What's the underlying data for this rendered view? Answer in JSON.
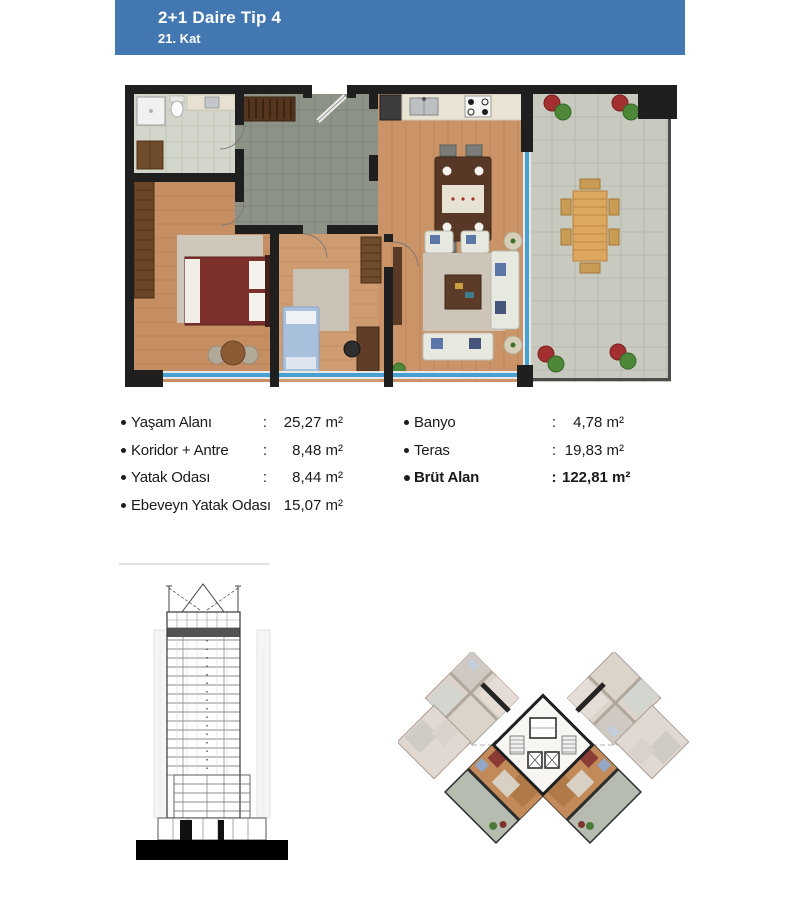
{
  "header": {
    "title": "2+1 Daire Tip 4",
    "subtitle": "21. Kat"
  },
  "areas": {
    "left": [
      {
        "label": "Yaşam Alanı",
        "sep": ":",
        "value": "25,27 m²"
      },
      {
        "label": "Koridor + Antre",
        "sep": ":",
        "value": "8,48 m²"
      },
      {
        "label": "Yatak Odası",
        "sep": ":",
        "value": "8,44 m²"
      },
      {
        "label": "Ebeveyn Yatak Odası",
        "sep": ":",
        "value": "15,07 m²"
      }
    ],
    "right": [
      {
        "label": "Banyo",
        "sep": ":",
        "value": "4,78 m²"
      },
      {
        "label": "Teras",
        "sep": ":",
        "value": "19,83 m²"
      },
      {
        "label": "Brüt Alan",
        "sep": ":",
        "value": "122,81 m²",
        "bold": true
      }
    ]
  },
  "figures": {
    "floor_plan": "apartment-floor-plan",
    "elevation": "building-elevation-21st-floor-highlighted",
    "key_plan": "typical-floor-key-plan"
  },
  "palette": {
    "header_bg": "#4377b2",
    "header_text": "#ffffff",
    "wall": "#1f1f1f",
    "wood_floor": "#cb9468",
    "bathroom_tile": "#d3d6ca",
    "corridor_tile": "#8e9387",
    "terrace_tile": "#c8cac0",
    "glass_blue": "#47a0d2",
    "text": "#1a1a1a",
    "divider": "#e0e0e0"
  }
}
